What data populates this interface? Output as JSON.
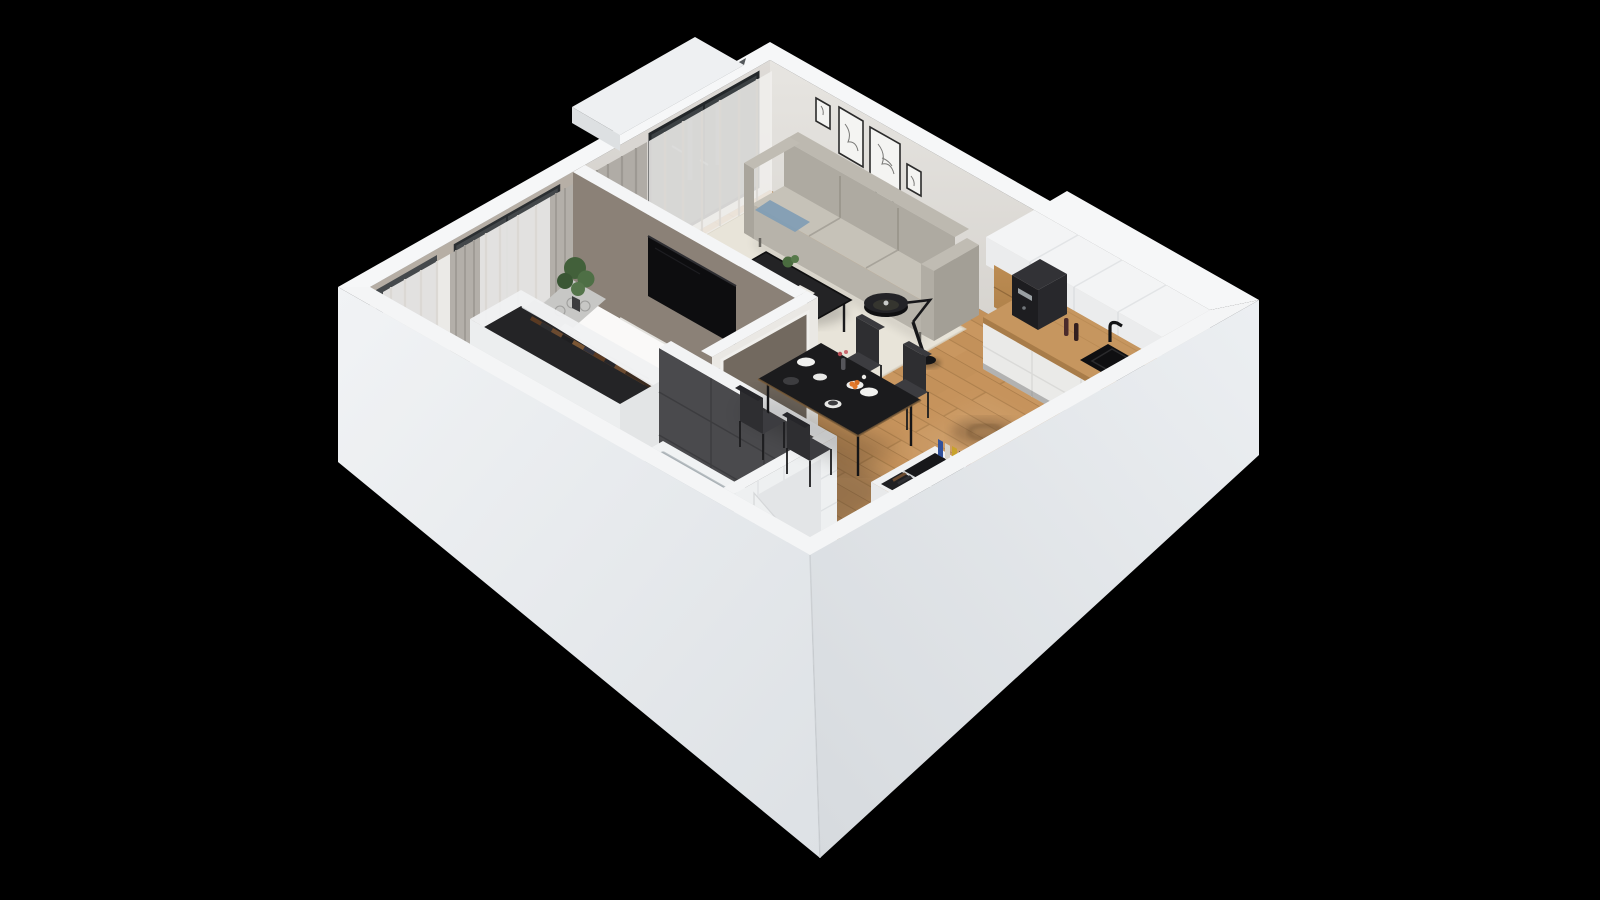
{
  "scene": {
    "type": "isometric-3d-floorplan-render",
    "background": "#000000",
    "view": "cutaway apartment seen from above at 45 degrees"
  },
  "palette": {
    "background": "#000000",
    "wall_band": "#f6f7f8",
    "wall_ext_sw": "#edeff2",
    "wall_ext_se": "#e4e7eb",
    "wall_nw_face": "#d6d3cf",
    "wall_ne_face": "#e3e1dd",
    "wall_taupe": "#a89d92",
    "partition_taupe": "#8b8177",
    "floor_wood": "#c6935c",
    "living_rug": "#e8e4d9",
    "bedroom_rug": "#cbc8c2",
    "sofa_light": "#c6c2b8",
    "sofa_mid": "#aeaaa1",
    "dining_table": "#1b1b1d",
    "chair_dark": "#3c3c40",
    "tv_black": "#0d0d0f",
    "counter_wood": "#c6965f",
    "niche_wood": "#b0804a",
    "cabinet_white": "#eaeae8",
    "bath_dark_wall": "#4a4a4d",
    "bath_tile_navy": "#334062",
    "tub_white": "#f0f2f3",
    "mat_black": "#141416",
    "plant_green": "#4a6b3f",
    "orange_fruit": "#e2782b"
  },
  "rooms": [
    {
      "name": "living-room",
      "items": [
        "3-seat gray sofa",
        "black metal coffee table",
        "arc floor lamp",
        "cream area rug",
        "gallery wall with 5 line-art frames",
        "balcony door with sheer and gray curtains"
      ],
      "frame_count": 5
    },
    {
      "name": "kitchen",
      "items": [
        "white tall cabinets",
        "wood open shelf niche",
        "wood countertop",
        "espresso machine",
        "2 spice grinders",
        "black sink with faucet",
        "black cooktop with 2 pots"
      ],
      "pot_count": 2
    },
    {
      "name": "dining-area",
      "items": [
        "black dining table",
        "4 dark chairs",
        "white and gray plates",
        "flower vase",
        "bowl of oranges"
      ],
      "chair_count": 4
    },
    {
      "name": "bedroom",
      "items": [
        "double bed with white duvet",
        "2 patterned gray pillows",
        "gray rug",
        "wall mounted tv",
        "potted plant",
        "black round side table",
        "windows with curtains"
      ],
      "pillow_count": 2
    },
    {
      "name": "wardrobe-nook",
      "items": [
        "open wardrobe rail",
        "hanging clothes"
      ]
    },
    {
      "name": "bathroom",
      "items": [
        "white bathtub",
        "dark tiled wall",
        "navy patterned tile floor",
        "wood vanity with white sink",
        "toilet paper holder",
        "open door"
      ]
    },
    {
      "name": "entry-hall",
      "items": [
        "front door",
        "white coat cabinet with books",
        "coat rail with clothes",
        "dark storage niche",
        "black doormat"
      ]
    }
  ]
}
